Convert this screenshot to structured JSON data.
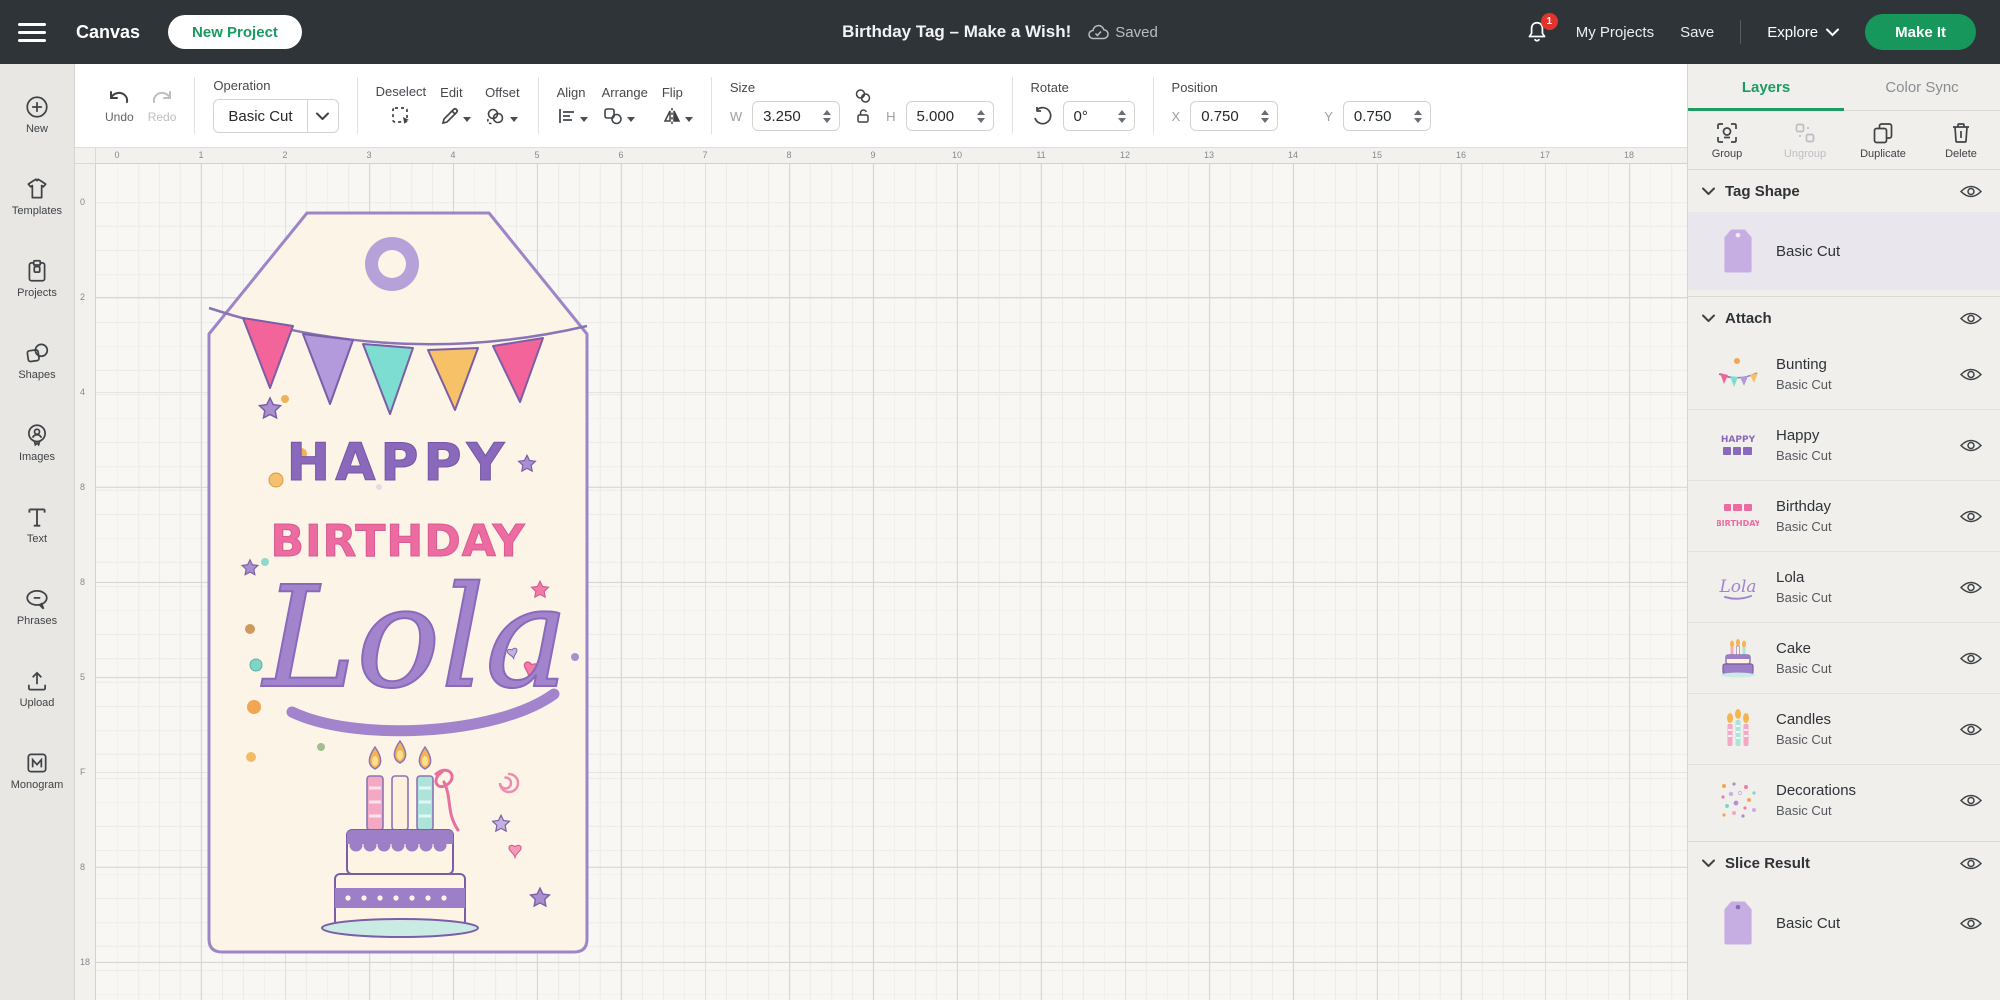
{
  "topbar": {
    "canvas_label": "Canvas",
    "new_project_label": "New Project",
    "title": "Birthday Tag – Make a Wish!",
    "saved_label": "Saved",
    "notification_count": "1",
    "my_projects_label": "My Projects",
    "save_label": "Save",
    "explore_label": "Explore",
    "make_it_label": "Make It"
  },
  "sidebar": {
    "items": [
      {
        "label": "New",
        "icon": "plus-circle-icon"
      },
      {
        "label": "Templates",
        "icon": "shirt-icon"
      },
      {
        "label": "Projects",
        "icon": "clipboard-icon"
      },
      {
        "label": "Shapes",
        "icon": "shapes-icon"
      },
      {
        "label": "Images",
        "icon": "images-icon"
      },
      {
        "label": "Text",
        "icon": "text-icon"
      },
      {
        "label": "Phrases",
        "icon": "speech-bubble-icon"
      },
      {
        "label": "Upload",
        "icon": "upload-icon"
      },
      {
        "label": "Monogram",
        "icon": "monogram-icon"
      }
    ]
  },
  "toolbar": {
    "undo_label": "Undo",
    "redo_label": "Redo",
    "operation_label": "Operation",
    "operation_value": "Basic Cut",
    "deselect_label": "Deselect",
    "edit_label": "Edit",
    "offset_label": "Offset",
    "align_label": "Align",
    "arrange_label": "Arrange",
    "flip_label": "Flip",
    "size_label": "Size",
    "w_label": "W",
    "w_value": "3.250",
    "h_label": "H",
    "h_value": "5.000",
    "rotate_label": "Rotate",
    "rotate_value": "0°",
    "position_label": "Position",
    "x_label": "X",
    "x_value": "0.750",
    "y_label": "Y",
    "y_value": "0.750"
  },
  "canvas": {
    "ruler_top": [
      "0",
      "1",
      "2",
      "3",
      "4",
      "5",
      "6",
      "7",
      "8",
      "9",
      "10",
      "11",
      "12",
      "13",
      "14",
      "15",
      "16",
      "17",
      "18"
    ],
    "ruler_left": [
      "0",
      "2",
      "4",
      "8",
      "8",
      "5",
      "F",
      "8",
      "18"
    ],
    "tag": {
      "line1": "HAPPY",
      "line2": "BIRTHDAY",
      "name": "Lola"
    }
  },
  "layers_panel": {
    "tabs": [
      {
        "label": "Layers",
        "active": true
      },
      {
        "label": "Color Sync",
        "active": false
      }
    ],
    "actions": [
      {
        "label": "Group",
        "disabled": false
      },
      {
        "label": "Ungroup",
        "disabled": true
      },
      {
        "label": "Duplicate",
        "disabled": false
      },
      {
        "label": "Delete",
        "disabled": false
      }
    ],
    "groups": [
      {
        "name": "Tag Shape",
        "items": [
          {
            "name": "",
            "operation": "Basic Cut",
            "thumb": "tag"
          }
        ]
      },
      {
        "name": "Attach",
        "items": [
          {
            "name": "Bunting",
            "operation": "Basic Cut",
            "thumb": "bunting"
          },
          {
            "name": "Happy",
            "operation": "Basic Cut",
            "thumb": "happy-text"
          },
          {
            "name": "Birthday",
            "operation": "Basic Cut",
            "thumb": "birthday-text"
          },
          {
            "name": "Lola",
            "operation": "Basic Cut",
            "thumb": "lola-script"
          },
          {
            "name": "Cake",
            "operation": "Basic Cut",
            "thumb": "cake"
          },
          {
            "name": "Candles",
            "operation": "Basic Cut",
            "thumb": "candles"
          },
          {
            "name": "Decorations",
            "operation": "Basic Cut",
            "thumb": "decorations"
          }
        ]
      },
      {
        "name": "Slice Result",
        "items": [
          {
            "name": "",
            "operation": "Basic Cut",
            "thumb": "tag"
          }
        ]
      }
    ]
  },
  "colors": {
    "brand_green": "#17975c",
    "active_tab_green": "#1d9b63",
    "topbar_bg": "#2e3438",
    "badge_red": "#e3342c",
    "tag_fill": "#fcf5e7",
    "tag_stroke": "#9d86c7",
    "purple_text": "#8a68bb",
    "pink_text": "#ec6ba1",
    "script_purple": "#a284cc",
    "flag_pink": "#f2649a",
    "flag_purple": "#b29add",
    "flag_teal": "#7eddd1",
    "flag_orange": "#f7c167"
  }
}
